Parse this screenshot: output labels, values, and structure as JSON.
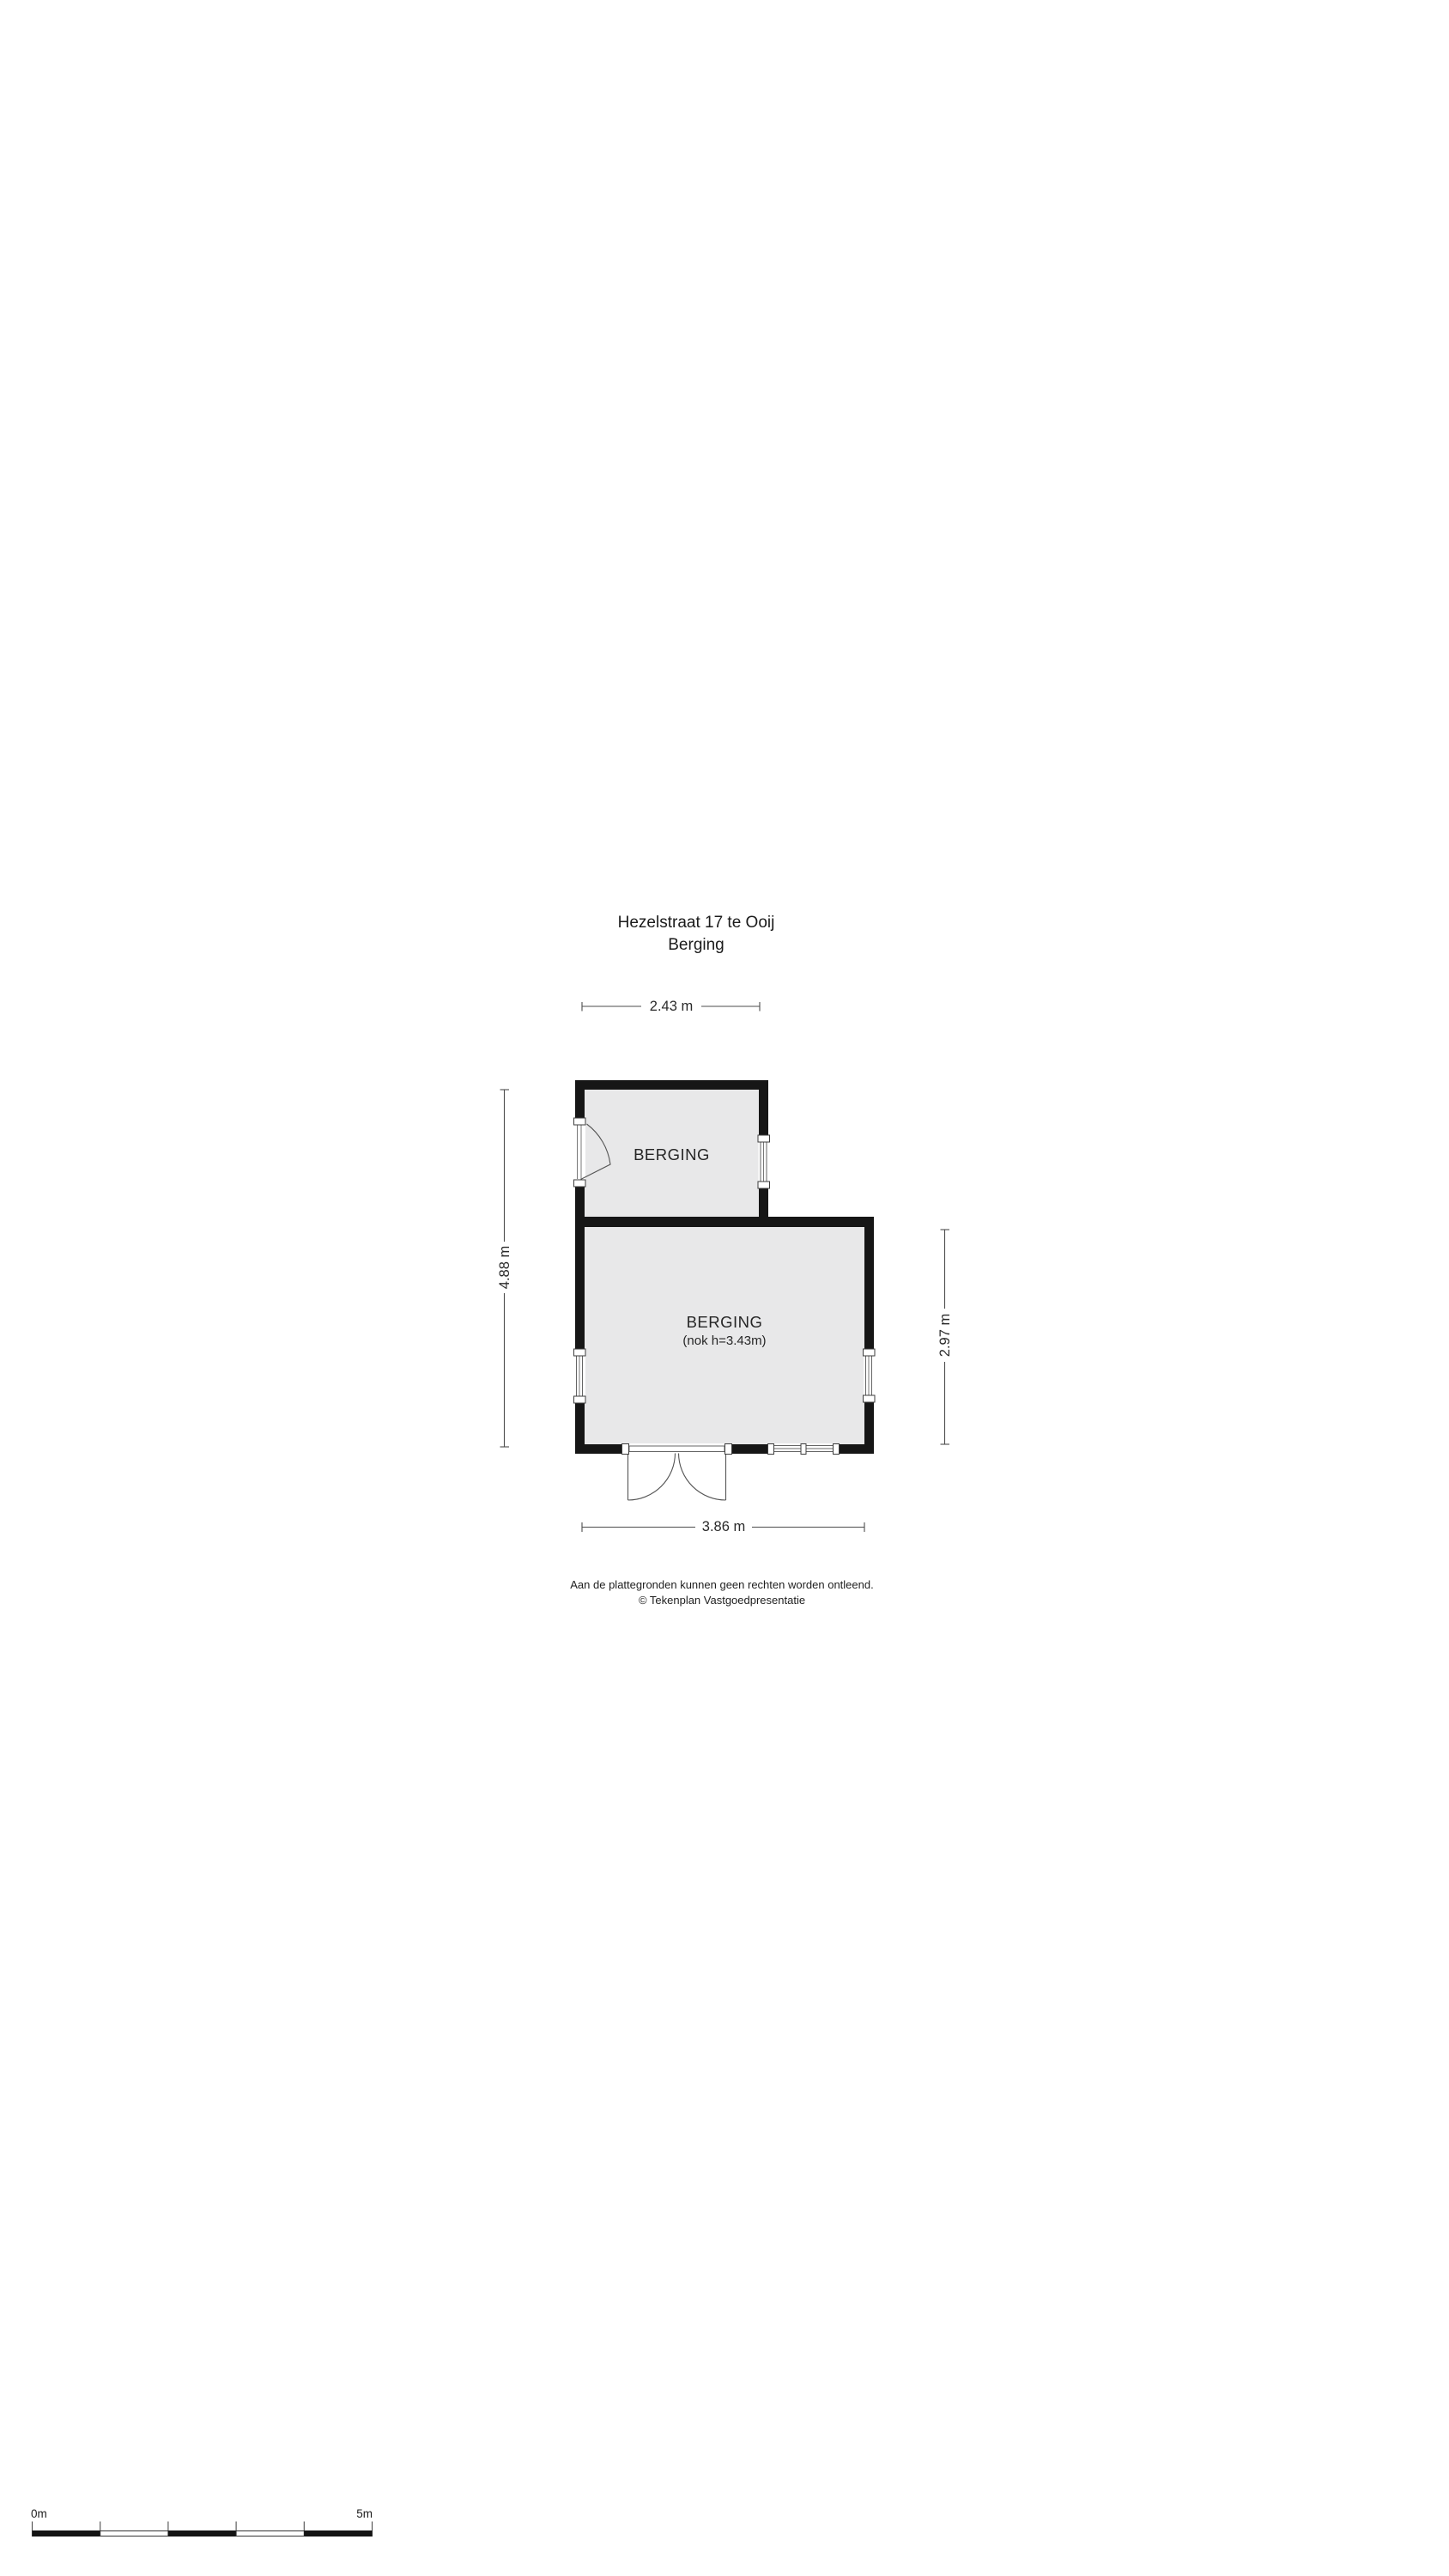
{
  "page_title": {
    "line1": "Hezelstraat 17 te Ooij",
    "line2": "Berging"
  },
  "rooms": {
    "upper": {
      "label": "BERGING"
    },
    "lower": {
      "label": "BERGING",
      "note": "(nok h=3.43m)"
    }
  },
  "dimensions": {
    "top": "2.43 m",
    "left": "4.88 m",
    "right": "2.97 m",
    "bottom": "3.86 m"
  },
  "footer": {
    "disclaimer": "Aan de plattegronden kunnen geen rechten worden ontleend.",
    "copyright": "© Tekenplan Vastgoedpresentatie"
  },
  "scale_bar": {
    "start": "0m",
    "end": "5m"
  },
  "colors": {
    "wall": "#161616",
    "room_fill": "#e8e8e9",
    "dimension_line": "#4d4d4d",
    "text": "#1c1c1c"
  }
}
